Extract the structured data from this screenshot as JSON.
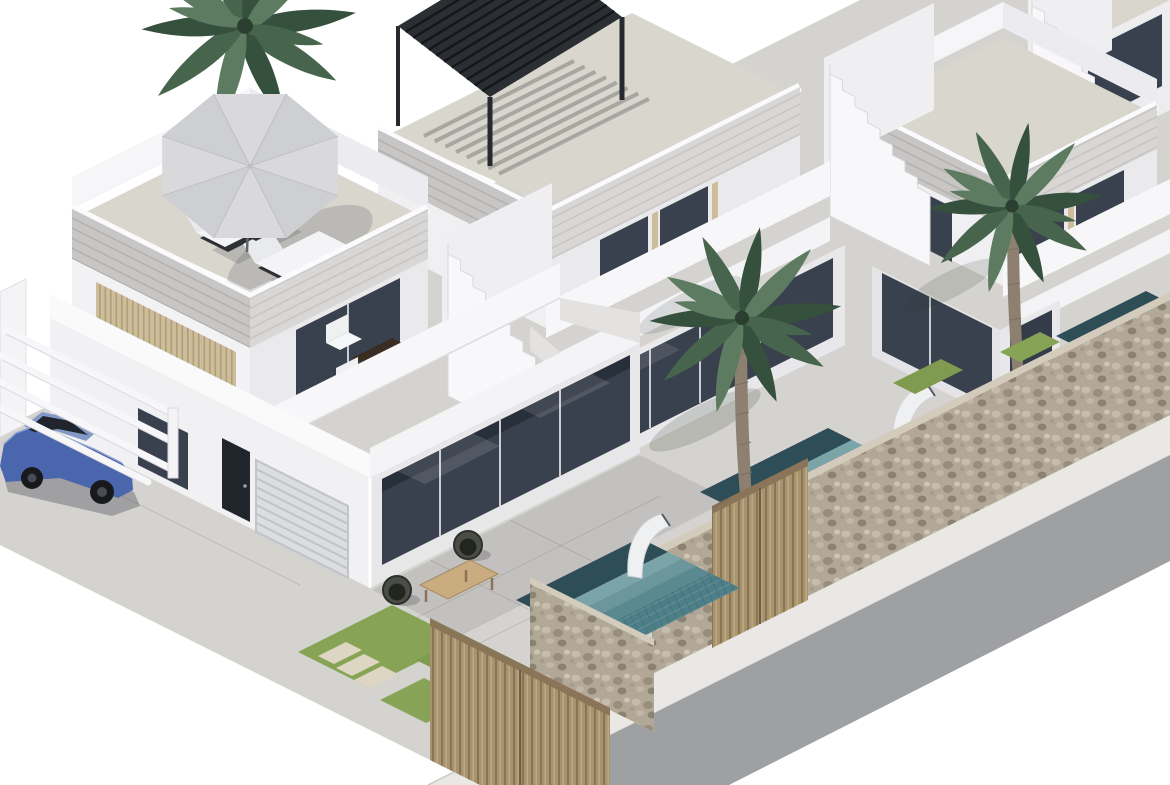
{
  "scene": {
    "type": "3d-architectural-rendering",
    "view": "isometric-aerial",
    "subject": "Row of modern two-storey white villas with roof terraces, private plunge pools, palm trees, stone perimeter walls with wooden slatted gates, parked blue sedan under carport pergola, sidewalk and asphalt road"
  },
  "palette": {
    "background": "#ffffff",
    "wall_white": "#f3f3f5",
    "wall_bright": "#fafafb",
    "wall_shaded": "#e8e8eb",
    "cladding_light": "#d8d7d5",
    "cladding_dark": "#c7c6c4",
    "terrace_floor": "#d9d6ce",
    "ground": "#d5d3cf",
    "sidewalk": "#e9e8e4",
    "road": "#9fa0a2",
    "glass": "#39414f",
    "frame": "#21252c",
    "louver": "#cdbd9b",
    "garage": "#dcdde0",
    "pergola": "#2b2e32",
    "stone": "#b2a897",
    "wood": "#a8936f",
    "pool_deep": "#2e4e57",
    "pool": "#4e7f88",
    "pool_step": "#7ba4a8",
    "grass": "#87a355",
    "paver": "#ddd6c2",
    "palm_dark": "#35503c",
    "palm": "#47654d",
    "palm_light": "#5d7b61",
    "trunk": "#8d8070",
    "car_body": "#4a66ad",
    "car_roof": "#8299c7",
    "car_glass": "#20242c",
    "umbrella": "#d9d9db"
  },
  "objects": {
    "villas": "4 terraced villas, white render with light-grey stone cladding bands",
    "roof_terrace_1": "parasol with two sun loungers and side table",
    "roof_terrace_2": "dark aluminium louvered pergola with slat shadows",
    "balcony": "bistro table with two white chairs",
    "patio": "two rattan lounge chairs with wooden coffee table",
    "pools": "three mosaic-tiled plunge pools with steps and white sculptural waterfalls",
    "walls": "natural stone walls with vertical wooden slat gates",
    "car": "blue sedan parked under white carport beams",
    "palms": "three large palm trees",
    "landscaping": "lawn patches with stepping stones",
    "street": "light sidewalk and grey asphalt road"
  }
}
